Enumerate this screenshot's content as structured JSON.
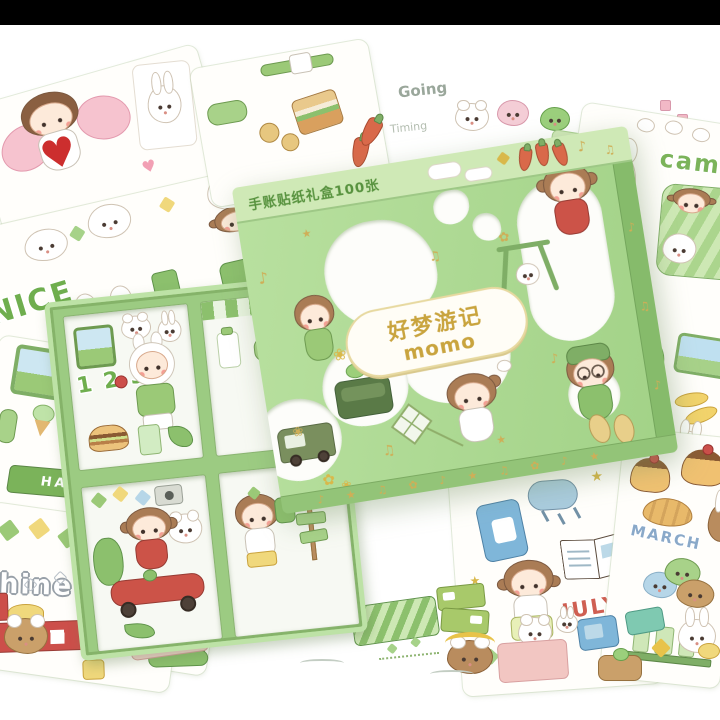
{
  "lid": {
    "edge_text": "手账贴纸礼盒100张",
    "logo_cn": "好梦游记",
    "logo_en": "momo"
  },
  "tray": {
    "pack_numbers": "1 2 3"
  },
  "sheet_labels": {
    "nice": "NICE",
    "camp": "camp",
    "happy": "HAPPY",
    "shine": "shine",
    "march": "MARCH",
    "july": "JULY",
    "going": "Going",
    "timing": "Timing"
  },
  "icons": {
    "heart": "♥",
    "music_note": "♪",
    "music_notes": "♫",
    "star": "★",
    "flower": "✿",
    "blossom": "❀",
    "bottom_edge_pattern": "♪ ★ ♫ ✿ ♪ ★ ♫ ✿ ♪ ★"
  },
  "colors": {
    "box_green": "#a9d68e",
    "box_green_light": "#cfe9b6",
    "box_green_dark": "#86bb6b",
    "gold_foil": "#c9a43e",
    "label_green": "#6fae4e",
    "label_blue": "#8aa9c9",
    "label_red": "#cf5f52",
    "letterbox": "#000000",
    "background": "#ffffff"
  }
}
